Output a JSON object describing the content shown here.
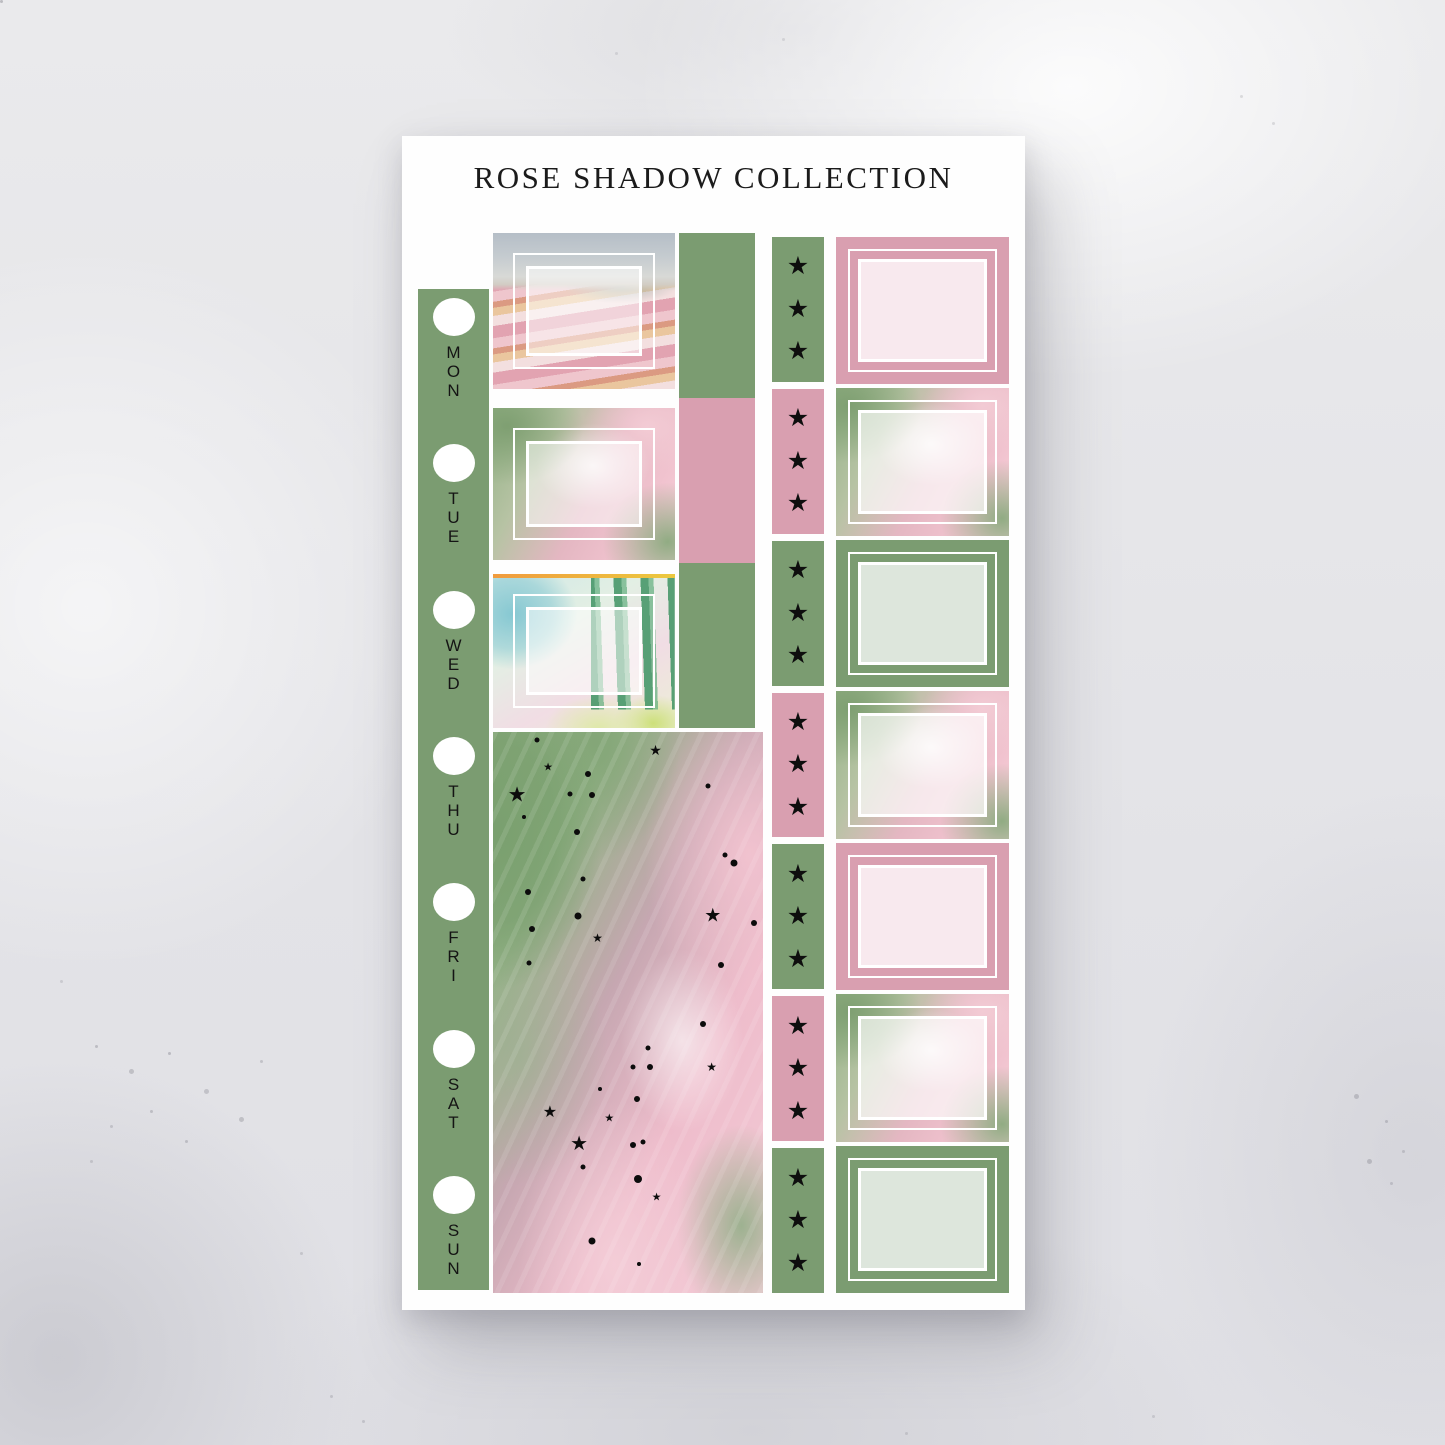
{
  "title": "ROSE SHADOW COLLECTION",
  "colors": {
    "green": "#7b9c71",
    "pink": "#d99fb0",
    "light_pink": "#f8e9ee",
    "light_green": "#dde6dc",
    "paper": "#fefefe",
    "ink": "#1b1b1b",
    "background": "#e4e4e7"
  },
  "day_strip": {
    "hole_icon": "white-circle",
    "days": [
      "MON",
      "TUE",
      "WED",
      "THU",
      "FRI",
      "SAT",
      "SUN"
    ]
  },
  "left_column": {
    "boxes": [
      {
        "name": "flower-field-box",
        "style": "tulip-field"
      },
      {
        "name": "paint-box",
        "style": "pink-green-paint"
      },
      {
        "name": "spires-box",
        "style": "teal-spires"
      }
    ]
  },
  "middle_rects": [
    {
      "color": "green"
    },
    {
      "color": "pink"
    },
    {
      "color": "green"
    }
  ],
  "star_strip": {
    "star_icon": "★",
    "segments": [
      {
        "color": "green",
        "stars": 3
      },
      {
        "color": "pink",
        "stars": 3
      },
      {
        "color": "green",
        "stars": 3
      },
      {
        "color": "pink",
        "stars": 3
      },
      {
        "color": "green",
        "stars": 3
      },
      {
        "color": "pink",
        "stars": 3
      },
      {
        "color": "green",
        "stars": 3
      }
    ]
  },
  "right_column": {
    "boxes": [
      {
        "variant": "pink"
      },
      {
        "variant": "paint"
      },
      {
        "variant": "green"
      },
      {
        "variant": "paint"
      },
      {
        "variant": "pink"
      },
      {
        "variant": "paint"
      },
      {
        "variant": "green"
      }
    ]
  },
  "big_box": {
    "style": "pink-green-paint-with-constellation",
    "marks": [
      {
        "t": "dot",
        "x": 16.4,
        "y": 1.4,
        "s": 5
      },
      {
        "t": "star",
        "x": 20.4,
        "y": 6.5,
        "s": 11
      },
      {
        "t": "star",
        "x": 60.2,
        "y": 3.2,
        "s": 14
      },
      {
        "t": "dot",
        "x": 35.3,
        "y": 7.5,
        "s": 6
      },
      {
        "t": "star",
        "x": 8.9,
        "y": 11.2,
        "s": 21
      },
      {
        "t": "dot",
        "x": 28.6,
        "y": 11.0,
        "s": 5
      },
      {
        "t": "dot",
        "x": 36.8,
        "y": 11.2,
        "s": 6
      },
      {
        "t": "dot",
        "x": 79.6,
        "y": 9.6,
        "s": 5
      },
      {
        "t": "dot",
        "x": 11.5,
        "y": 15.1,
        "s": 4
      },
      {
        "t": "dot",
        "x": 31.2,
        "y": 17.8,
        "s": 6
      },
      {
        "t": "dot",
        "x": 85.9,
        "y": 21.9,
        "s": 5
      },
      {
        "t": "dot",
        "x": 89.2,
        "y": 23.3,
        "s": 7
      },
      {
        "t": "dot",
        "x": 33.5,
        "y": 26.2,
        "s": 5
      },
      {
        "t": "dot",
        "x": 13.0,
        "y": 28.5,
        "s": 6
      },
      {
        "t": "dot",
        "x": 31.6,
        "y": 32.8,
        "s": 7
      },
      {
        "t": "star",
        "x": 81.4,
        "y": 32.8,
        "s": 19
      },
      {
        "t": "dot",
        "x": 96.6,
        "y": 34.1,
        "s": 6
      },
      {
        "t": "dot",
        "x": 14.5,
        "y": 35.2,
        "s": 6
      },
      {
        "t": "star",
        "x": 38.7,
        "y": 36.8,
        "s": 12
      },
      {
        "t": "dot",
        "x": 13.3,
        "y": 41.2,
        "s": 5
      },
      {
        "t": "dot",
        "x": 84.4,
        "y": 41.6,
        "s": 6
      },
      {
        "t": "dot",
        "x": 77.7,
        "y": 52.0,
        "s": 6
      },
      {
        "t": "dot",
        "x": 57.3,
        "y": 56.3,
        "s": 5
      },
      {
        "t": "dot",
        "x": 51.7,
        "y": 59.7,
        "s": 5
      },
      {
        "t": "dot",
        "x": 58.0,
        "y": 59.7,
        "s": 6
      },
      {
        "t": "star",
        "x": 81.0,
        "y": 59.7,
        "s": 12
      },
      {
        "t": "dot",
        "x": 39.7,
        "y": 63.6,
        "s": 4
      },
      {
        "t": "dot",
        "x": 53.5,
        "y": 65.4,
        "s": 6
      },
      {
        "t": "star",
        "x": 21.1,
        "y": 68.0,
        "s": 16
      },
      {
        "t": "star",
        "x": 43.1,
        "y": 69.0,
        "s": 11
      },
      {
        "t": "star",
        "x": 31.9,
        "y": 73.4,
        "s": 20
      },
      {
        "t": "dot",
        "x": 51.7,
        "y": 73.6,
        "s": 6
      },
      {
        "t": "dot",
        "x": 55.4,
        "y": 73.1,
        "s": 5
      },
      {
        "t": "dot",
        "x": 33.4,
        "y": 77.5,
        "s": 5
      },
      {
        "t": "dot",
        "x": 53.8,
        "y": 79.7,
        "s": 8
      },
      {
        "t": "star",
        "x": 60.6,
        "y": 83.0,
        "s": 11
      },
      {
        "t": "dot",
        "x": 36.8,
        "y": 90.7,
        "s": 7
      },
      {
        "t": "dot",
        "x": 54.2,
        "y": 94.8,
        "s": 4
      }
    ]
  }
}
